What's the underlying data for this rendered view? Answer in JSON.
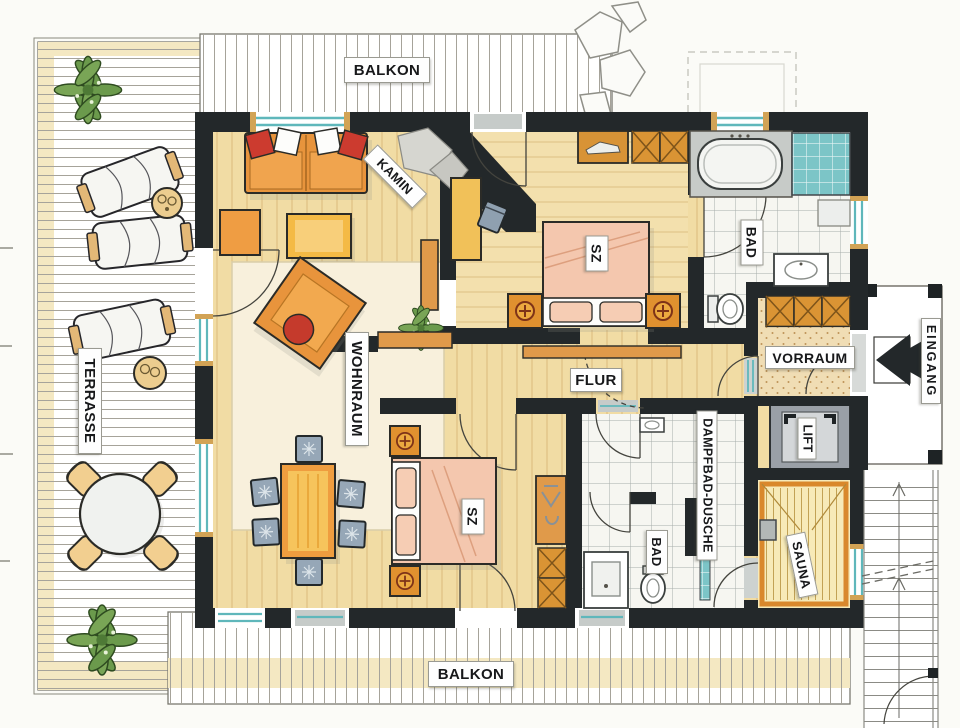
{
  "document": {
    "type": "apartment floor plan, hand-drawn marker sketch"
  },
  "plan": {
    "rooms": {
      "balkon_top": {
        "label": "BALKON"
      },
      "terrasse": {
        "label": "TERRASSE"
      },
      "wohnraum": {
        "label": "WOHNRAUM"
      },
      "kamin": {
        "label": "KAMIN"
      },
      "sz_upper": {
        "label": "SZ"
      },
      "bad_upper": {
        "label": "BAD"
      },
      "vorraum": {
        "label": "VORRAUM"
      },
      "eingang": {
        "label": "EINGANG"
      },
      "lift": {
        "label": "LIFT"
      },
      "flur": {
        "label": "FLUR"
      },
      "sz_lower": {
        "label": "SZ"
      },
      "dampfbad_dusche": {
        "label": "DAMPFBAD-DUSCHE"
      },
      "bad_lower": {
        "label": "BAD"
      },
      "sauna": {
        "label": "SAUNA"
      },
      "balkon_bottom": {
        "label": "BALKON"
      }
    },
    "colors": {
      "wall": "#23282a",
      "wood_floor": "#f1dca4",
      "wood_grain": "#c79e58",
      "rug": "#f8f0dc",
      "furniture_orange": "#e8943c",
      "table_gold": "#f4ba45",
      "bed_pink": "#f4c7ae",
      "window_teal": "#5fb7bb",
      "tile_bg": "#f6f6f1",
      "chair_gray": "#96a7b7",
      "sauna_wood": "#f7eab8",
      "lift_gray": "#9aa0a7",
      "plant_green": "#6b9a4c",
      "terrace_band": "#f4e8c2",
      "pillow_red": "#cc3b2f"
    }
  }
}
